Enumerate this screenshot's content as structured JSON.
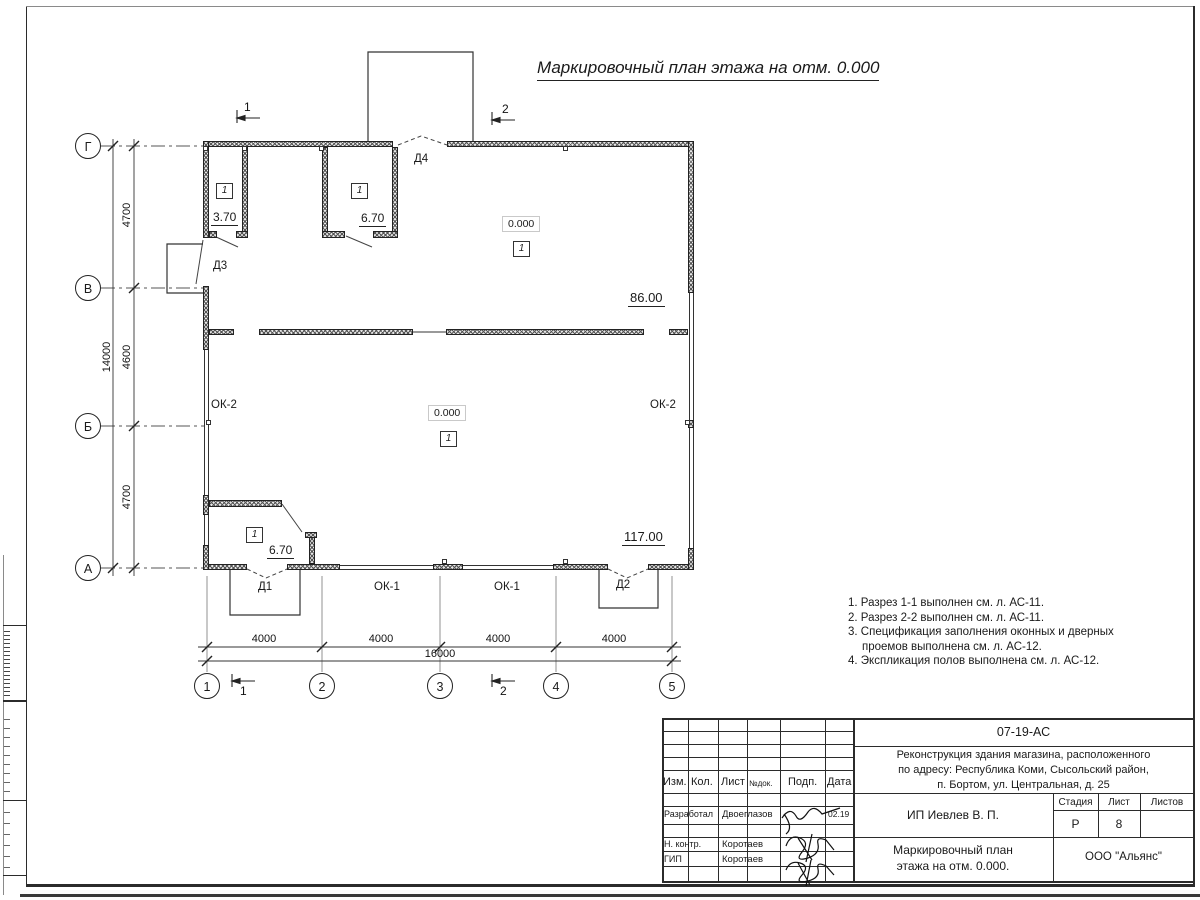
{
  "title": "Маркировочный план этажа на отм. 0.000",
  "plan": {
    "axes_vertical": [
      "Г",
      "В",
      "Б",
      "А"
    ],
    "axes_horizontal": [
      "1",
      "2",
      "3",
      "4",
      "5"
    ],
    "dims": {
      "v_segments": [
        "4700",
        "4600",
        "4700"
      ],
      "v_total": "14000",
      "h_segments": [
        "4000",
        "4000",
        "4000",
        "4000"
      ],
      "h_total": "16000"
    },
    "sections": {
      "s1": "1",
      "s2": "2"
    },
    "labels": {
      "d1": "Д1",
      "d2": "Д2",
      "d3": "Д3",
      "d4": "Д4",
      "ok1": "ОК-1",
      "ok2": "ОК-2"
    },
    "rooms": {
      "top_left": {
        "num": "1",
        "area": "3.70"
      },
      "top_mid": {
        "num": "1",
        "area": "6.70"
      },
      "hall_top": {
        "elev": "0.000",
        "num": "1",
        "area": "86.00"
      },
      "hall_main": {
        "elev": "0.000",
        "num": "1",
        "area": "117.00"
      },
      "bottom_left": {
        "num": "1",
        "area": "6.70"
      }
    }
  },
  "notes": {
    "lines": [
      "1. Разрез 1-1 выполнен см. л. АС-11.",
      "2. Разрез 2-2 выполнен см. л. АС-11.",
      "3. Спецификация заполнения оконных и дверных",
      "проемов выполнена см. л. АС-12.",
      "4. Экспликация полов выполнена см. л. АС-12."
    ]
  },
  "stamp": {
    "doc_number": "07-19-АС",
    "project_lines": [
      "Реконструкция здания магазина, расположенного",
      "по адресу: Республика Коми, Сысольский район,",
      "п. Бортом, ул. Центральная, д. 25"
    ],
    "header": {
      "izm": "Изм.",
      "kol": "Кол.",
      "list": "Лист",
      "ndok": "№док.",
      "podp": "Подп.",
      "data": "Дата"
    },
    "rows": [
      {
        "role": "Разработал",
        "name": "Двоеглазов",
        "date": "02.19"
      },
      {
        "role": "Н. контр.",
        "name": "Коротаев",
        "date": ""
      },
      {
        "role": "ГИП",
        "name": "Коротаев",
        "date": ""
      }
    ],
    "client": "ИП Иевлев В. П.",
    "stage_header": {
      "stage": "Стадия",
      "sheet": "Лист",
      "sheets": "Листов"
    },
    "stage_value": "Р",
    "sheet_value": "8",
    "sheets_value": "",
    "drawing_title_lines": [
      "Маркировочный план",
      "этажа на отм. 0.000."
    ],
    "company": "ООО \"Альянс\""
  }
}
